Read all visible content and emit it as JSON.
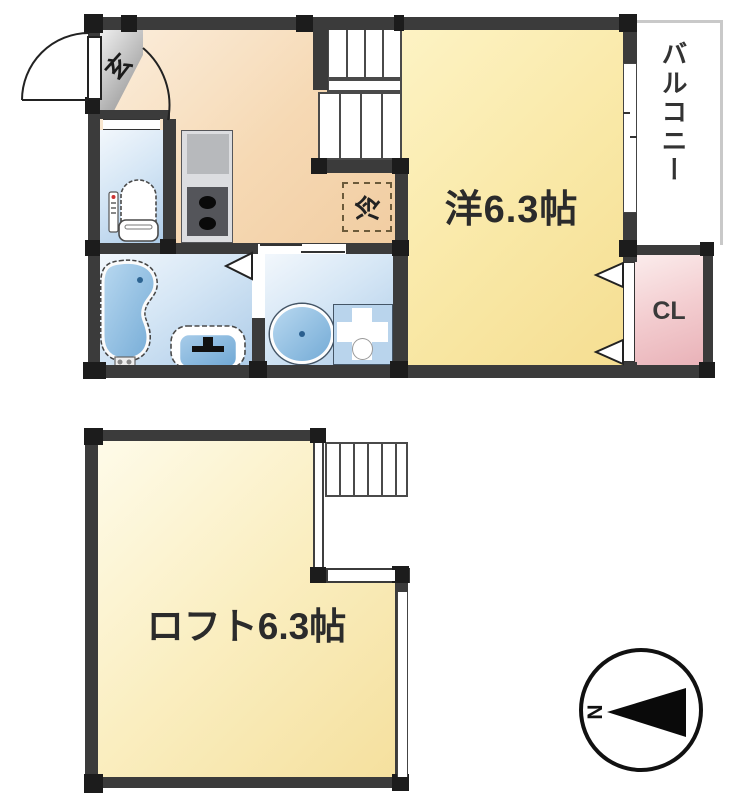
{
  "plan": {
    "upper_floor": {
      "entrance_label": "玄",
      "main_room_label": "洋6.3帖",
      "balcony_label": "バルコニー",
      "closet_label": "CL",
      "refrigerator_label": "冷"
    },
    "lower_floor": {
      "loft_label": "ロフト6.3帖"
    },
    "compass": {
      "north_label": "N"
    },
    "colors": {
      "wall": "#3b3b3b",
      "room_yellow": "#f8e59e",
      "hall_peach": "#f4d4ac",
      "wet_area_blue": "#aecce8",
      "closet_pink": "#e9b2b8",
      "entrance_gray": "#969696",
      "fixture_blue": "#8fc0e4"
    }
  }
}
